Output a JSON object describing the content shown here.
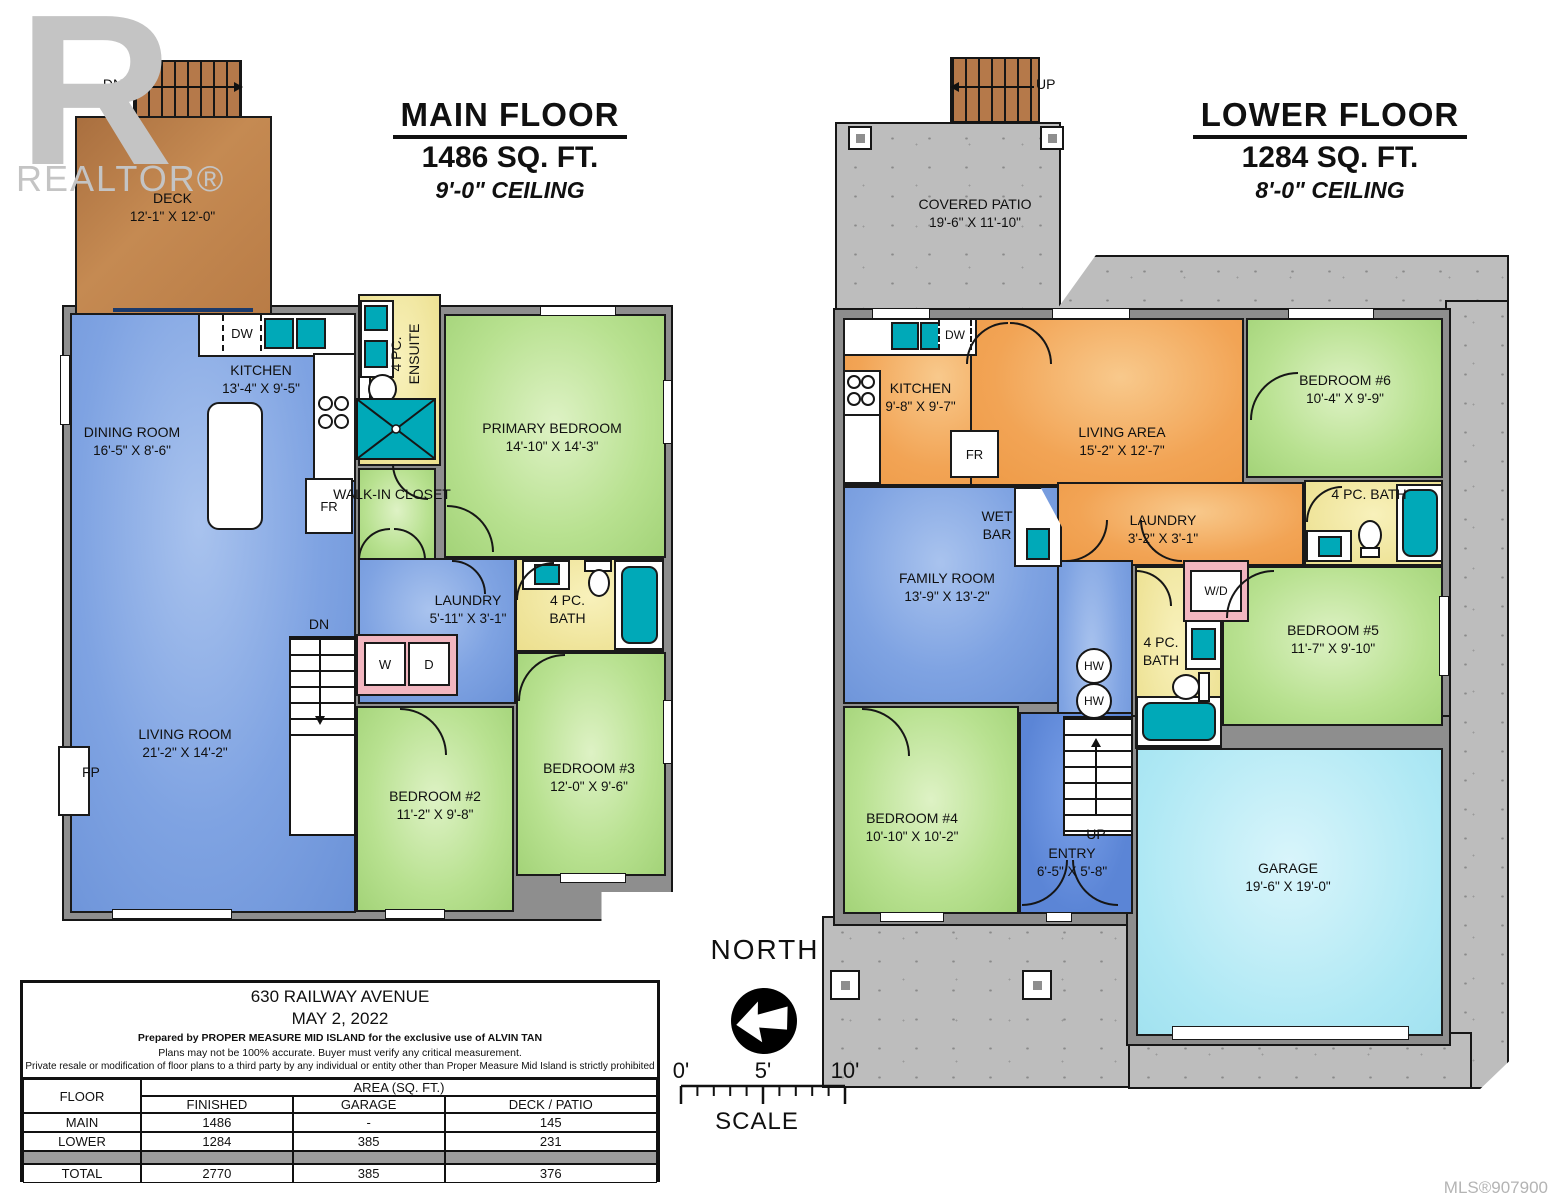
{
  "watermark": {
    "letter": "R",
    "text": "REALTOR®"
  },
  "mls": "MLS®907900",
  "compass_label": "NORTH",
  "scale": {
    "t0": "0'",
    "t5": "5'",
    "t10": "10'",
    "label": "SCALE"
  },
  "fixtures": {
    "dw": "DW",
    "fr": "FR",
    "washer": "W",
    "dryer": "D",
    "wd": "W/D",
    "hw": "HW",
    "fp": "FP",
    "dn": "DN",
    "up": "UP"
  },
  "main_floor": {
    "title": "MAIN FLOOR",
    "area": "1486 SQ. FT.",
    "ceiling": "9'-0\" CEILING",
    "rooms": {
      "deck": {
        "name": "DECK",
        "dims": "12'-1\" X 12'-0\""
      },
      "dining": {
        "name": "DINING ROOM",
        "dims": "16'-5\" X 8'-6\""
      },
      "kitchen": {
        "name": "KITCHEN",
        "dims": "13'-4\" X 9'-5\""
      },
      "ensuite": {
        "name": "4 PC. ENSUITE"
      },
      "primary": {
        "name": "PRIMARY BEDROOM",
        "dims": "14'-10\" X 14'-3\""
      },
      "walkin": {
        "name": "WALK-IN CLOSET"
      },
      "laundry": {
        "name": "LAUNDRY",
        "dims": "5'-11\" X 3'-1\""
      },
      "bath": {
        "name": "4 PC. BATH"
      },
      "living": {
        "name": "LIVING ROOM",
        "dims": "21'-2\" X 14'-2\""
      },
      "bed2": {
        "name": "BEDROOM #2",
        "dims": "11'-2\" X 9'-8\""
      },
      "bed3": {
        "name": "BEDROOM #3",
        "dims": "12'-0\" X 9'-6\""
      }
    }
  },
  "lower_floor": {
    "title": "LOWER FLOOR",
    "area": "1284 SQ. FT.",
    "ceiling": "8'-0\" CEILING",
    "rooms": {
      "patio": {
        "name": "COVERED PATIO",
        "dims": "19'-6\" X 11'-10\""
      },
      "kitchen": {
        "name": "KITCHEN",
        "dims": "9'-8\" X 9'-7\""
      },
      "living": {
        "name": "LIVING AREA",
        "dims": "15'-2\" X 12'-7\""
      },
      "bed6": {
        "name": "BEDROOM #6",
        "dims": "10'-4\" X 9'-9\""
      },
      "bath_right": {
        "name": "4 PC. BATH"
      },
      "wetbar": {
        "name": "WET BAR"
      },
      "laundry": {
        "name": "LAUNDRY",
        "dims": "3'-2\" X 3'-1\""
      },
      "family": {
        "name": "FAMILY ROOM",
        "dims": "13'-9\" X 13'-2\""
      },
      "bath_mid": {
        "name": "4 PC. BATH"
      },
      "bed5": {
        "name": "BEDROOM #5",
        "dims": "11'-7\" X 9'-10\""
      },
      "bed4": {
        "name": "BEDROOM #4",
        "dims": "10'-10\" X 10'-2\""
      },
      "entry": {
        "name": "ENTRY",
        "dims": "6'-5\" X 5'-8\""
      },
      "garage": {
        "name": "GARAGE",
        "dims": "19'-6\" X 19'-0\""
      }
    }
  },
  "info": {
    "address": "630 RAILWAY AVENUE",
    "date": "MAY 2, 2022",
    "prepared": "Prepared by PROPER MEASURE MID ISLAND for the exclusive use of ALVIN TAN",
    "accuracy": "Plans may not be 100% accurate.  Buyer must verify any critical measurement.",
    "resale": "Private resale  or modification of floor plans to a third party by any individual or entity other than Proper Measure Mid Island is strictly prohibited",
    "table": {
      "floor_header": "FLOOR",
      "area_header": "AREA (SQ. FT.)",
      "col_finished": "FINISHED",
      "col_garage": "GARAGE",
      "col_deck": "DECK / PATIO",
      "rows": [
        {
          "floor": "MAIN",
          "finished": "1486",
          "garage": "-",
          "deck": "145"
        },
        {
          "floor": "LOWER",
          "finished": "1284",
          "garage": "385",
          "deck": "231"
        },
        {
          "floor": "TOTAL",
          "finished": "2770",
          "garage": "385",
          "deck": "376"
        }
      ]
    }
  },
  "colors": {
    "wall_gray": "#8e8e8e",
    "room_blue": "#7fa3e2",
    "room_green": "#b8e190",
    "room_yellow": "#efe49a",
    "room_orange": "#f2a455",
    "garage_cyan": "#aee8f4",
    "entry_blue": "#5b85d6",
    "fixture_teal": "#00a9b8",
    "deck_brown": "#bf8148",
    "wd_pink": "#f2b6c0",
    "concrete_gray": "#bdbdbd",
    "watermark_gray": "#c4c4c4"
  }
}
